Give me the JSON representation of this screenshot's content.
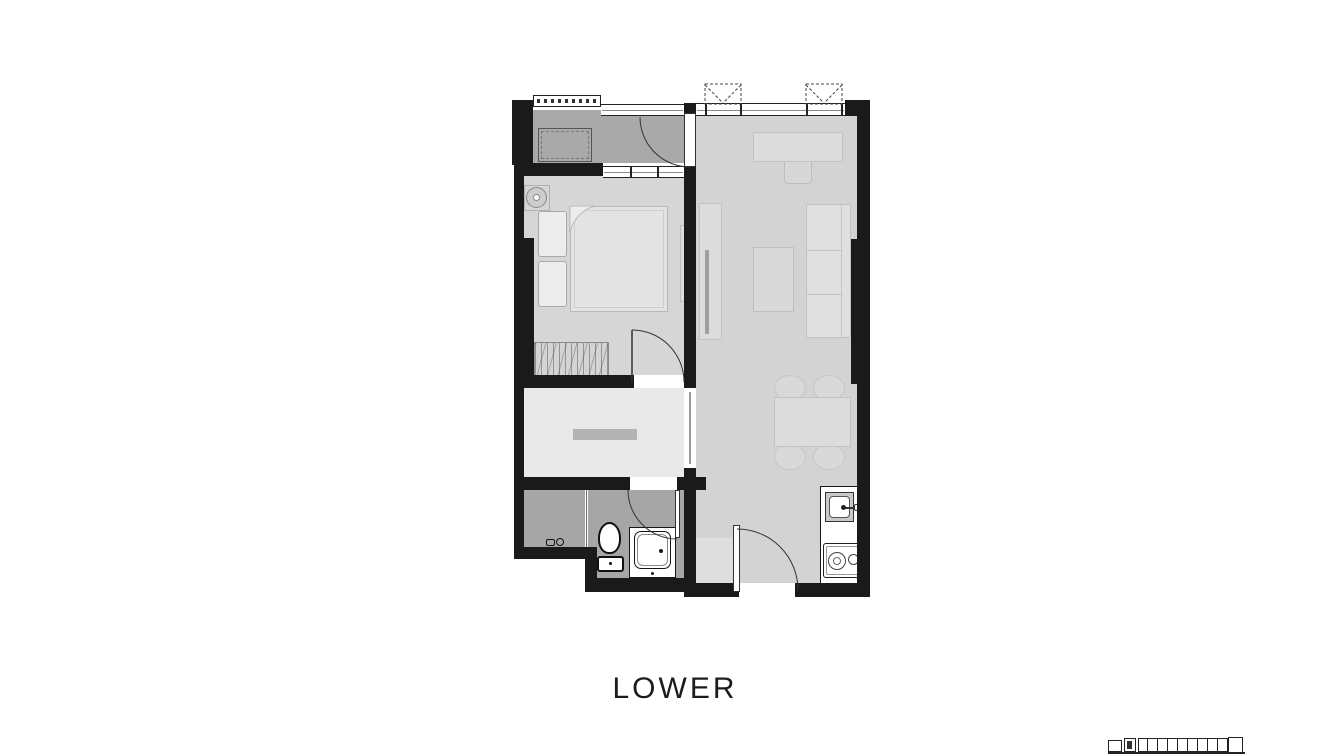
{
  "title": {
    "label": "LOWER"
  },
  "colors": {
    "wall": "#1a1a1a",
    "floor_living": "#d3d3d3",
    "floor_bedroom": "#d6d6d6",
    "floor_hall": "#e9e9e9",
    "floor_wet": "#a6a6a6",
    "floor_balcony": "#a9a9a9",
    "fixture_outline": "#161616",
    "caption_text": "#1c1c1c"
  },
  "keyplan": {
    "cell_count": 9
  }
}
